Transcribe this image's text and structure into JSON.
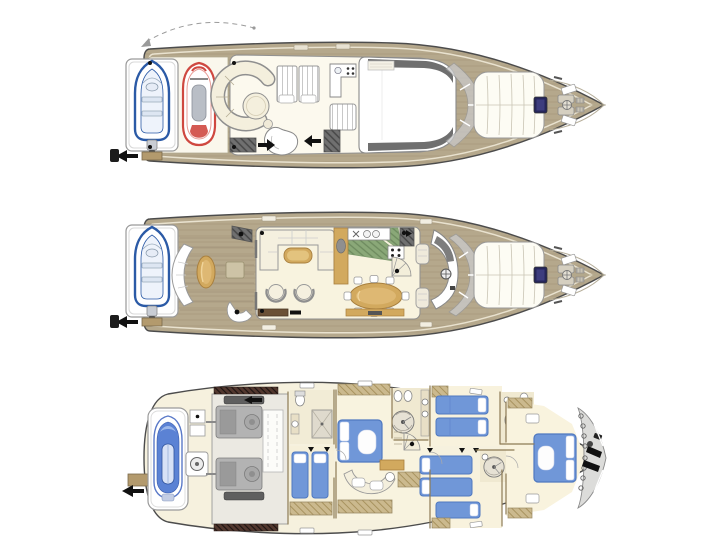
{
  "page": {
    "width": 728,
    "height": 546,
    "background": "#ffffff"
  },
  "figure": {
    "type": "yacht-deck-plans",
    "view": "top-down",
    "deck_count": 3,
    "decks": [
      {
        "id": "flybridge-deck",
        "position": "top",
        "features": [
          "tender-on-platform",
          "boarding-arrow",
          "crane-swing-path",
          "jet-ski",
          "circular-settee",
          "cocktail-table",
          "sun-pads",
          "wet-bar",
          "sun-bench",
          "chaise-lounge",
          "stairway-pads",
          "hardtop-roof",
          "windshield",
          "bow-sun-pad",
          "deck-hatch",
          "anchor-windlass",
          "bow-pulpit"
        ]
      },
      {
        "id": "main-deck",
        "position": "middle",
        "features": [
          "tender-on-platform",
          "boarding-arrow",
          "transom-seat",
          "cockpit-table",
          "cockpit-hatch",
          "flybridge-stairs",
          "salon-sofa",
          "coffee-table",
          "armchairs",
          "sideboard",
          "galley",
          "stove",
          "sinks",
          "dining-table",
          "dining-chairs",
          "companionway-stairs",
          "spiral-stairs",
          "helm-console",
          "helm-seats",
          "windshield",
          "bow-sun-pad",
          "deck-hatch",
          "anchor-windlass"
        ]
      },
      {
        "id": "lower-deck",
        "position": "bottom",
        "features": [
          "stern-platform",
          "garage-jet-ski",
          "storage-lockers",
          "generator",
          "engine-room",
          "engines",
          "vent-grilles",
          "crew-bathroom",
          "crew-cabin",
          "stairs-landing",
          "master-cabin",
          "master-bed",
          "master-bathroom",
          "round-showers",
          "vanity",
          "curved-sofa",
          "wardrobes",
          "twin-cabin-starboard",
          "twin-cabin-port",
          "guest-bathrooms",
          "vip-cabin",
          "vip-bed",
          "chain-locker",
          "anchor-chain",
          "windlass-gear"
        ]
      }
    ]
  },
  "palette": {
    "background": "#ffffff",
    "hull-stroke": "#4c4c4c",
    "teak": "#b5a88c",
    "teak-line": "#a3947a",
    "cream": "#f7f2e0",
    "floor-cream": "#f8f3df",
    "white": "#ffffff",
    "wood": "#d2a95e",
    "wood-dark": "#a87f3e",
    "wardrobe-tan": "#cbb98e",
    "bed-blue": "#7097d8",
    "bed-blue-dark": "#4f78c0",
    "galley-green": "#8aa878",
    "engine-gray": "#b3b3b3",
    "gray-dark": "#6e6e6e",
    "glass-gray": "#c9c9c9",
    "jetski-red": "#cf4840",
    "tender-blue": "#2b5aa6",
    "hatch-navy": "#26265a",
    "arrow-black": "#111111",
    "locker-gray": "#dcdcda",
    "wall-brown": "#8d7b55"
  }
}
